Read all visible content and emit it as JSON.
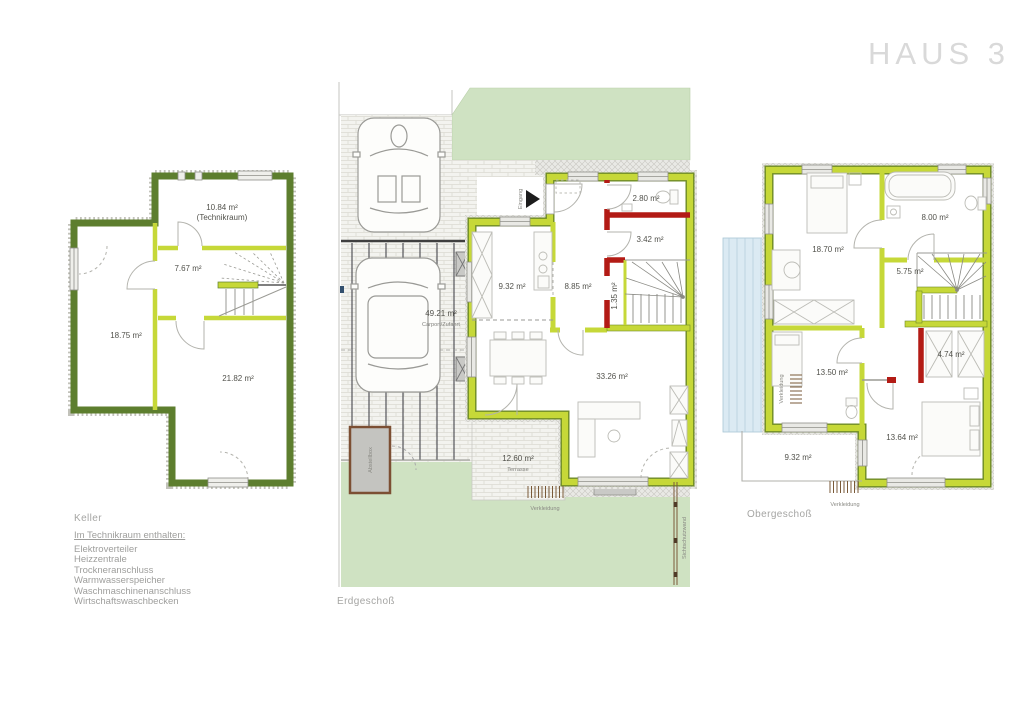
{
  "title": "HAUS 3",
  "colors": {
    "wall_dark_green": "#5d7e2e",
    "wall_lime": "#c6d838",
    "wall_red": "#b31b15",
    "lawn_green": "#cfe2c2",
    "glazing_blue": "#dbeaf3",
    "title_gray": "#d9d9d9"
  },
  "floors": {
    "keller": {
      "caption": "Keller",
      "rooms": {
        "technikraum_area": "10.84 m²",
        "technikraum_label": "(Technikraum)",
        "flur_area": "7.67 m²",
        "room_left_area": "18.75 m²",
        "room_bottom_area": "21.82 m²"
      },
      "legend_heading": "Im Technikraum enthalten:",
      "legend_items": [
        "Elektroverteiler",
        "Heizzentrale",
        "Trockneranschluss",
        "Warmwasserspeicher",
        "Waschmaschinenanschluss",
        "Wirtschaftswaschbecken"
      ]
    },
    "erdgeschoss": {
      "caption": "Erdgeschoß",
      "rooms": {
        "carport_area": "49.21 m²",
        "carport_label": "Carport/Zufahrt",
        "kueche_area": "9.32 m²",
        "diele_area": "8.85 m²",
        "wc_area": "2.80 m²",
        "abstell_area": "3.42 m²",
        "schacht_area": "1.35 m²",
        "wohnen_area": "33.26 m²",
        "terrasse_area": "12.60 m²",
        "terrasse_label": "Terrasse"
      },
      "annotations": {
        "eingang": "Eingang",
        "abstellbox": "Abstellbox",
        "verkleidung": "Verkleidung",
        "sichtschutzwand": "Sichtschutzwand"
      }
    },
    "obergeschoss": {
      "caption": "Obergeschoß",
      "rooms": {
        "zimmer1_area": "18.70 m²",
        "bad_area": "8.00 m²",
        "flur_area": "5.75 m²",
        "schrank_area": "4.74 m²",
        "zimmer2_area": "13.50 m²",
        "zimmer3_area": "13.64 m²",
        "balkon_area": "9.32 m²"
      },
      "annotations": {
        "verkleidung_left": "Verkleidung",
        "verkleidung_bottom": "Verkleidung"
      }
    }
  }
}
